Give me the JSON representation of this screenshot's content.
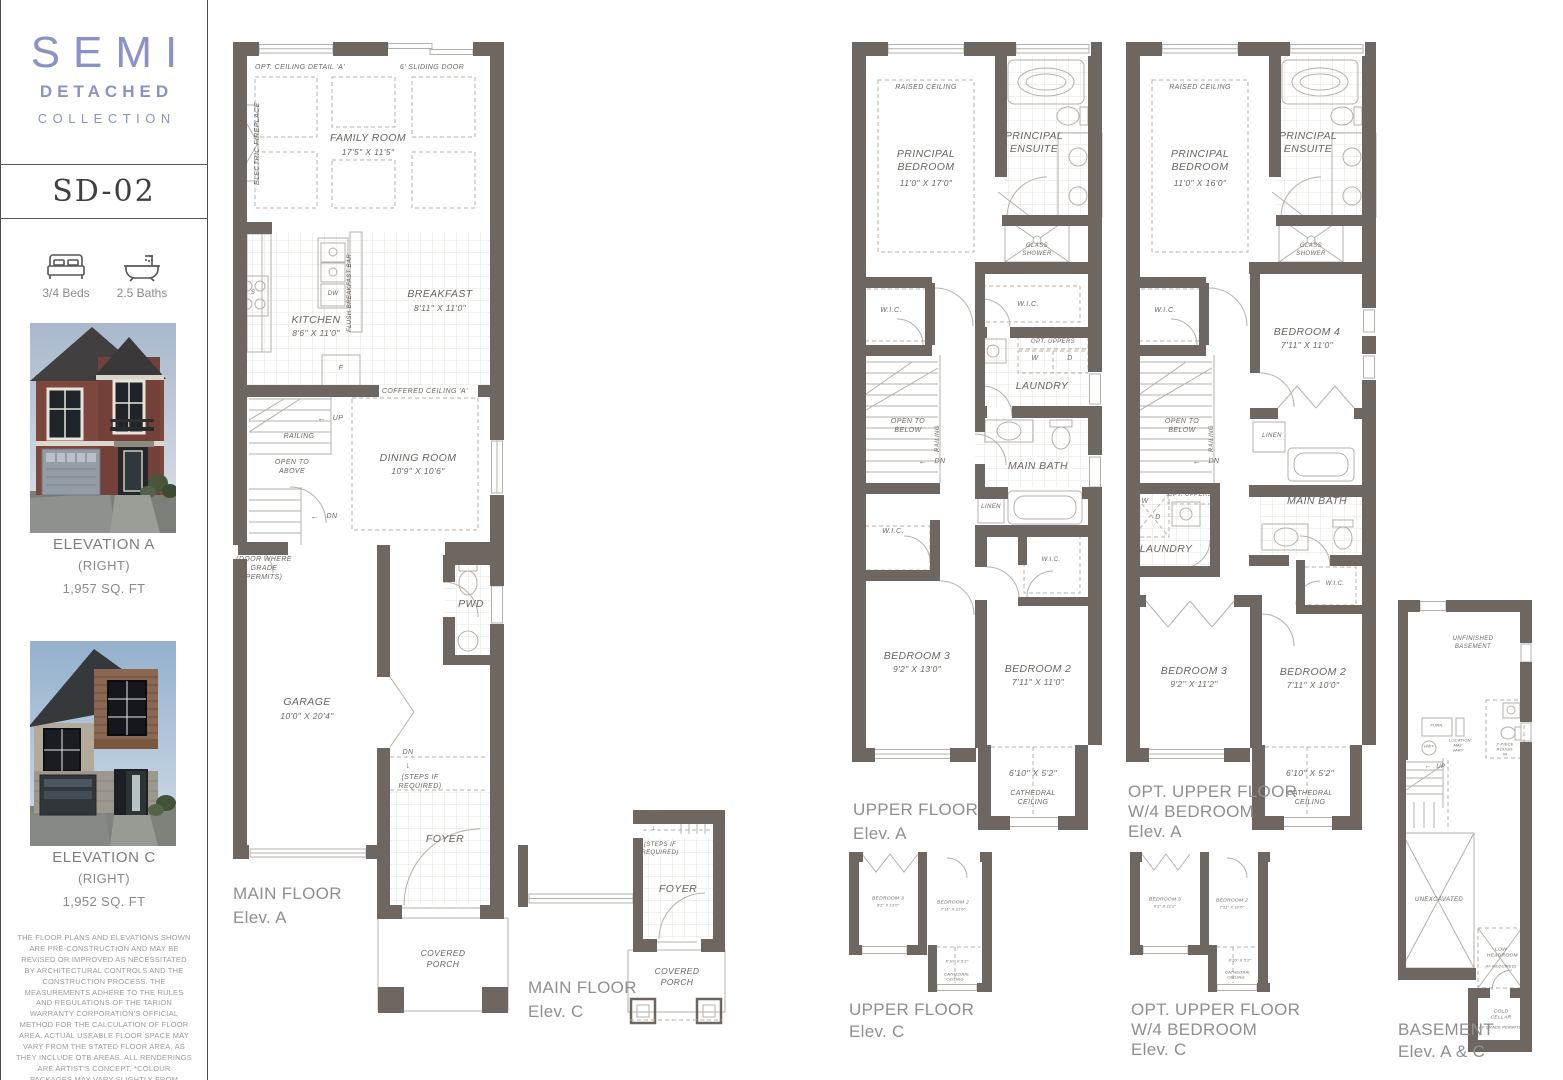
{
  "sidebar": {
    "logo_line1": "SEMI",
    "logo_line2": "DETACHED",
    "logo_line3": "COLLECTION",
    "model": "SD-02",
    "beds": "3/4 Beds",
    "baths": "2.5 Baths",
    "elevation_a": {
      "title": "ELEVATION A",
      "subtitle": "(RIGHT)",
      "area": "1,957 SQ. FT"
    },
    "elevation_c": {
      "title": "ELEVATION C",
      "subtitle": "(RIGHT)",
      "area": "1,952 SQ. FT"
    },
    "disclaimer": "THE FLOOR PLANS AND ELEVATIONS SHOWN ARE PRE-CONSTRUCTION AND MAY BE REVISED OR IMPROVED AS NECESSITATED BY ARCHITECTURAL CONTROLS AND THE CONSTRUCTION PROCESS. THE MEASUREMENTS ADHERE TO THE RULES AND REGULATIONS OF THE TARION WARRANTY CORPORATION'S OFFICIAL METHOD FOR THE CALCULATION OF FLOOR AREA. ACTUAL USEABLE FLOOR SPACE MAY VARY FROM THE STATED FLOOR AREA, AS THEY INCLUDE OTB AREAS. ALL RENDERINGS ARE ARTIST'S CONCEPT. *COLOUR PACKAGES MAY VARY SLIGHTLY FROM RENDERINGS. REFER TO SALES REPRESENTATIVE FOR DETAILS. E. & O. E."
  },
  "colors": {
    "accent": "#8a92c7",
    "walls": "#6e6761",
    "line": "#b5b0aa",
    "caption": "#8f8f8f"
  },
  "fp": {
    "opt_ceiling_detail": "OPT. CEILING DETAIL 'A'",
    "sliding_door": "6' SLIDING DOOR",
    "family_room": "FAMILY ROOM",
    "family_room_dim": "17'5\" X 11'5\"",
    "electric_fireplace": "ELECTRIC FIREPLACE",
    "kitchen": "KITCHEN",
    "kitchen_dim": "8'6\" X 11'0\"",
    "breakfast": "BREAKFAST",
    "breakfast_dim": "8'11\" X 11'0\"",
    "dw": "DW",
    "f": "F",
    "s": "S",
    "w": "W",
    "d": "D",
    "flush_breakfast_bar": "FLUSH BREAKFAST BAR",
    "opt_coffered": "OPT. COFFERED CEILING 'A'",
    "dining_room": "DINING ROOM",
    "dining_room_dim": "10'9\" X 10'6\"",
    "up": "UP",
    "dn": "DN",
    "railing": "RAILING",
    "open_to_above": "OPEN TO ABOVE",
    "open_to_below": "OPEN TO BELOW",
    "door_where_grade": "(DOOR WHERE GRADE PERMITS)",
    "garage": "GARAGE",
    "garage_dim": "10'0\" X 20'4\"",
    "pwd": "PWD",
    "foyer": "FOYER",
    "covered_porch": "COVERED PORCH",
    "steps_if_required": "(STEPS IF REQUIRED)",
    "raised_ceiling": "RAISED CEILING",
    "principal_bedroom": "PRINCIPAL BEDROOM",
    "principal_bedroom_dim_a": "11'0\" X 17'0\"",
    "principal_bedroom_dim_opt": "11'0\" X 16'0\"",
    "principal_ensuite": "PRINCIPAL ENSUITE",
    "glass_shower": "GLASS SHOWER",
    "wic": "W.I.C.",
    "opt_uppers": "OPT. UPPERS",
    "laundry": "LAUNDRY",
    "linen": "LINEN",
    "main_bath": "MAIN BATH",
    "bedroom2": "BEDROOM 2",
    "bedroom3": "BEDROOM 3",
    "bedroom4": "BEDROOM 4",
    "bedroom2_dim_a": "7'11\" X 11'0\"",
    "bedroom3_dim_a": "9'2\" X 13'0\"",
    "bedroom2_dim_opt": "7'11\" X 10'0\"",
    "bedroom3_dim_opt": "9'2\" X 11'2\"",
    "bedroom4_dim": "7'11\" X 11'0\"",
    "nook_dim": "6'10\" X 5'2\"",
    "cathedral_ceiling": "CATHEDRAL CEILING",
    "unfinished_basement": "UNFINISHED BASEMENT",
    "furn": "FURN.",
    "hwt": "HWT",
    "location_may_vary": "LOCATION MAY VARY",
    "rough_in": "2-PIECE ROUGH-IN",
    "unexcavated": "UNEXCAVATED",
    "low_headroom": "LOW HEADROOM",
    "if_required": "(IF REQUIRED)",
    "cold_cellar": "COLD CELLAR",
    "if_grade_permits": "(IF GRADE PERMITS)",
    "arrow_left": "←",
    "arrow_down": "↓"
  },
  "captions": {
    "main_a": {
      "l1": "MAIN FLOOR",
      "l2": "Elev. A"
    },
    "main_c": {
      "l1": "MAIN FLOOR",
      "l2": "Elev. C"
    },
    "upper_a": {
      "l1": "UPPER FLOOR",
      "l2": "Elev. A"
    },
    "upper_c": {
      "l1": "UPPER FLOOR",
      "l2": "Elev. C"
    },
    "opt_a": {
      "l1": "OPT. UPPER FLOOR",
      "l2": "W/4 BEDROOM",
      "l3": "Elev. A"
    },
    "opt_c": {
      "l1": "OPT. UPPER FLOOR",
      "l2": "W/4 BEDROOM",
      "l3": "Elev. C"
    },
    "basement": {
      "l1": "BASEMENT",
      "l2": "Elev. A & C"
    }
  }
}
